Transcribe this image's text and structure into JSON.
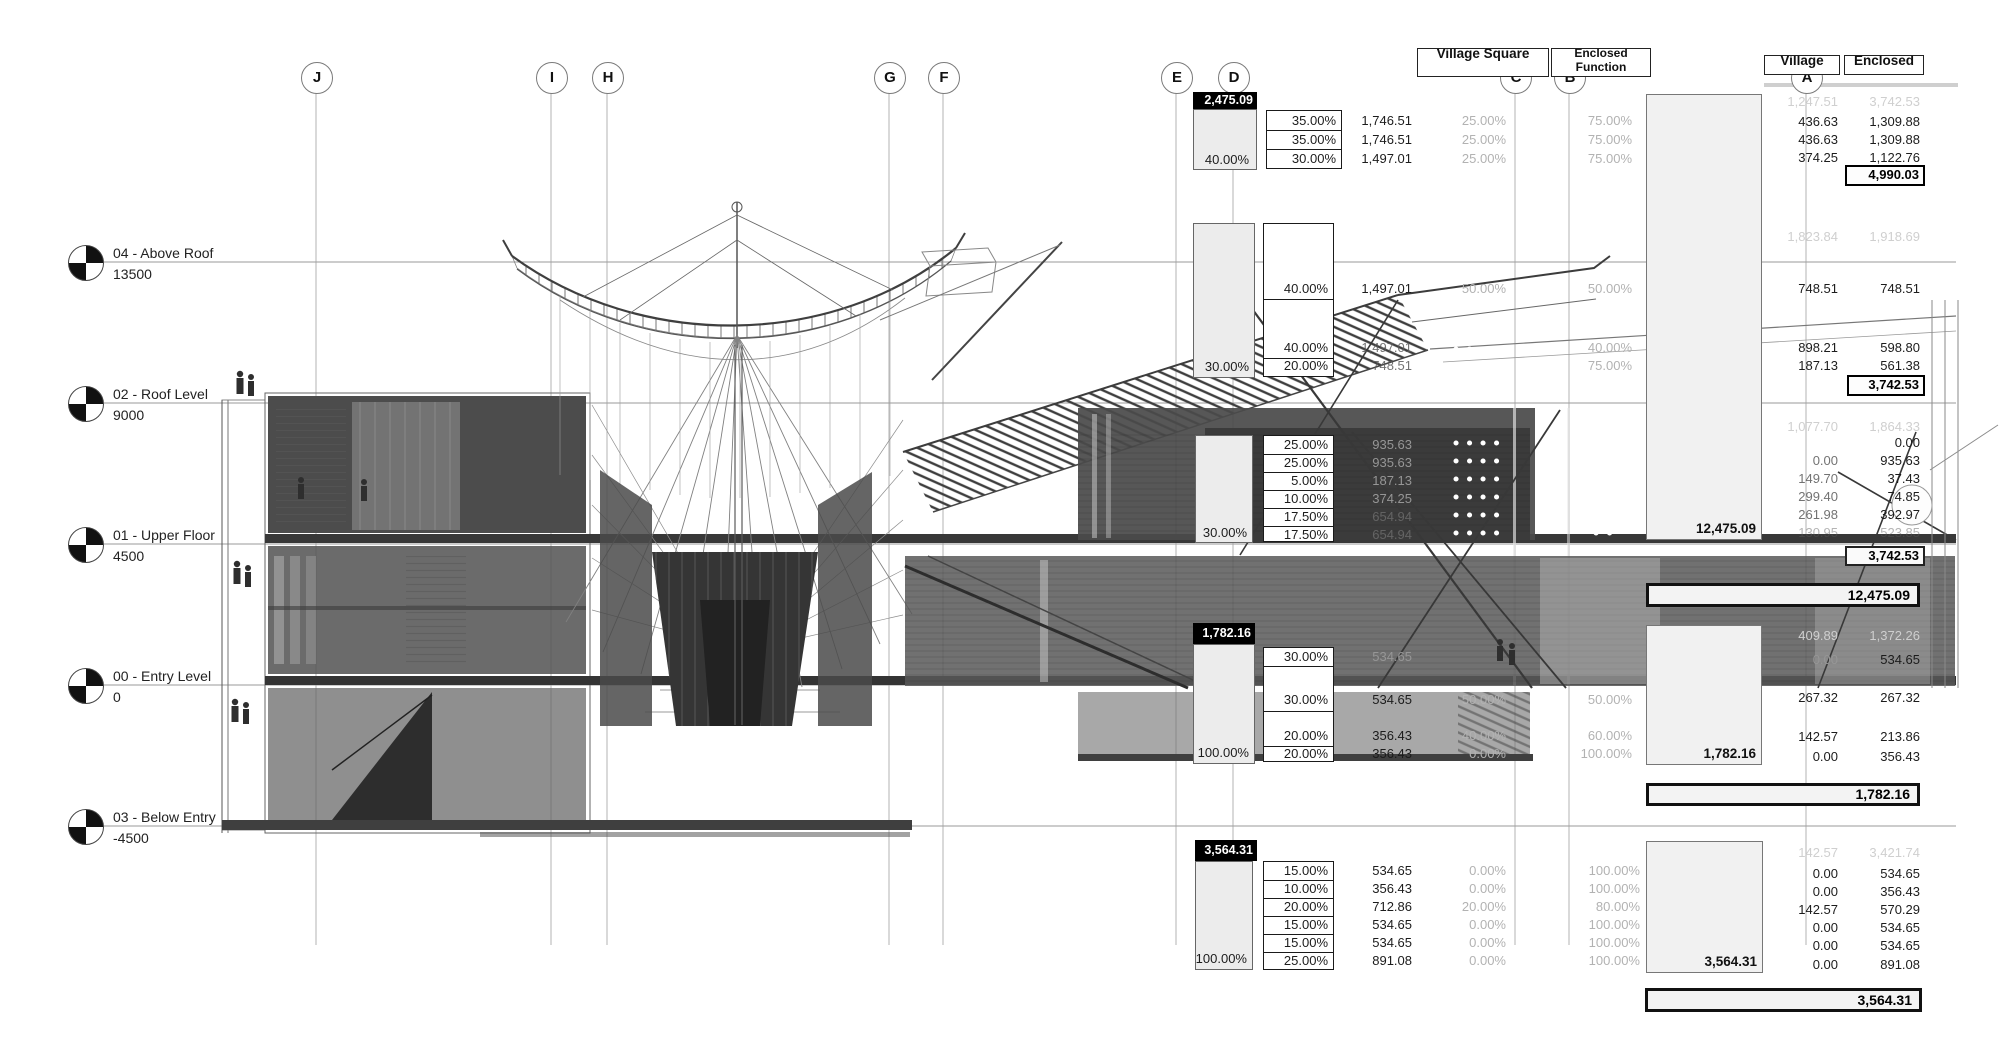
{
  "grid_bubbles": [
    "J",
    "I",
    "H",
    "G",
    "F",
    "E",
    "D",
    "C",
    "B",
    "A"
  ],
  "levels": [
    {
      "name": "04 - Above Roof",
      "elevation": "13500"
    },
    {
      "name": "02 - Roof Level",
      "elevation": "9000"
    },
    {
      "name": "01 - Upper Floor",
      "elevation": "4500"
    },
    {
      "name": "00 - Entry Level",
      "elevation": "0"
    },
    {
      "name": "03 - Below Entry",
      "elevation": "-4500"
    }
  ],
  "headers": {
    "function_left": "Village Square",
    "function_right": "Enclosed Function",
    "village": "Village",
    "enclosed": "Enclosed"
  },
  "blocks": {
    "b1": {
      "header_value": "2,475.09",
      "gray_pct": "40.00%",
      "pcts": [
        "35.00%",
        "35.00%",
        "30.00%"
      ],
      "values": [
        "1,746.51",
        "1,746.51",
        "1,497.01"
      ],
      "col3": [
        "25.00%",
        "25.00%",
        "25.00%"
      ],
      "col4": [
        "75.00%",
        "75.00%",
        "75.00%"
      ],
      "faint": {
        "v1": "1,247.51",
        "v2": "3,742.53"
      },
      "right": [
        [
          "436.63",
          "1,309.88"
        ],
        [
          "436.63",
          "1,309.88"
        ],
        [
          "374.25",
          "1,122.76"
        ]
      ],
      "total": "4,990.03"
    },
    "b2a": {
      "gray_pct": "30.00%",
      "pcts": [
        "40.00%",
        "40.00%",
        "20.00%"
      ],
      "values": [
        "1,497.01",
        "1,497.01",
        "748.51"
      ],
      "col3": [
        "50.00%"
      ],
      "col4": [
        "50.00%",
        "40.00%",
        "75.00%"
      ],
      "faint": {
        "v1": "1,823.84",
        "v2": "1,918.69"
      },
      "right": [
        [
          "748.51",
          "748.51"
        ],
        [
          "898.21",
          "598.80"
        ],
        [
          "187.13",
          "561.38"
        ]
      ],
      "total": "3,742.53"
    },
    "b2b": {
      "gray_pct": "30.00%",
      "pcts": [
        "25.00%",
        "25.00%",
        "5.00%",
        "10.00%",
        "17.50%",
        "17.50%"
      ],
      "values": [
        "935.63",
        "935.63",
        "187.13",
        "374.25",
        "654.94",
        "654.94"
      ],
      "faint": {
        "v1": "1,077.70",
        "v2": "1,864.33"
      },
      "right": [
        [
          "",
          "0.00"
        ],
        [
          "0.00",
          "935.63"
        ],
        [
          "149.70",
          "37.43"
        ],
        [
          "299.40",
          "74.85"
        ],
        [
          "261.98",
          "392.97"
        ],
        [
          "130.95",
          "523.85"
        ]
      ],
      "total": "3,742.53",
      "column_total": "12,475.09",
      "grand_total": "12,475.09"
    },
    "b3": {
      "header_value": "1,782.16",
      "gray_pct": "100.00%",
      "pcts": [
        "30.00%",
        "30.00%",
        "20.00%",
        "20.00%"
      ],
      "values": [
        "534.65",
        "534.65",
        "356.43",
        "356.43"
      ],
      "col3": [
        "50.00%",
        "40.00%",
        "0.00%"
      ],
      "col4": [
        "50.00%",
        "60.00%",
        "100.00%"
      ],
      "faint": {
        "v1": "409.89",
        "v2": "1,372.26"
      },
      "right": [
        [
          "0.00",
          "534.65"
        ],
        [
          "267.32",
          "267.32"
        ],
        [
          "142.57",
          "213.86"
        ],
        [
          "0.00",
          "356.43"
        ]
      ],
      "column_total": "1,782.16",
      "grand_total": "1,782.16"
    },
    "b4": {
      "header_value": "3,564.31",
      "gray_pct": "100.00%",
      "pcts": [
        "15.00%",
        "10.00%",
        "20.00%",
        "15.00%",
        "15.00%",
        "25.00%"
      ],
      "values": [
        "534.65",
        "356.43",
        "712.86",
        "534.65",
        "534.65",
        "891.08"
      ],
      "col3": [
        "0.00%",
        "0.00%",
        "20.00%",
        "0.00%",
        "0.00%",
        "0.00%"
      ],
      "col4": [
        "100.00%",
        "100.00%",
        "80.00%",
        "100.00%",
        "100.00%",
        "100.00%"
      ],
      "faint": {
        "v1": "142.57",
        "v2": "3,421.74"
      },
      "right": [
        [
          "0.00",
          "534.65"
        ],
        [
          "0.00",
          "356.43"
        ],
        [
          "142.57",
          "570.29"
        ],
        [
          "0.00",
          "534.65"
        ],
        [
          "0.00",
          "534.65"
        ],
        [
          "0.00",
          "891.08"
        ]
      ],
      "column_total": "3,564.31",
      "grand_total": "3,564.31"
    }
  }
}
